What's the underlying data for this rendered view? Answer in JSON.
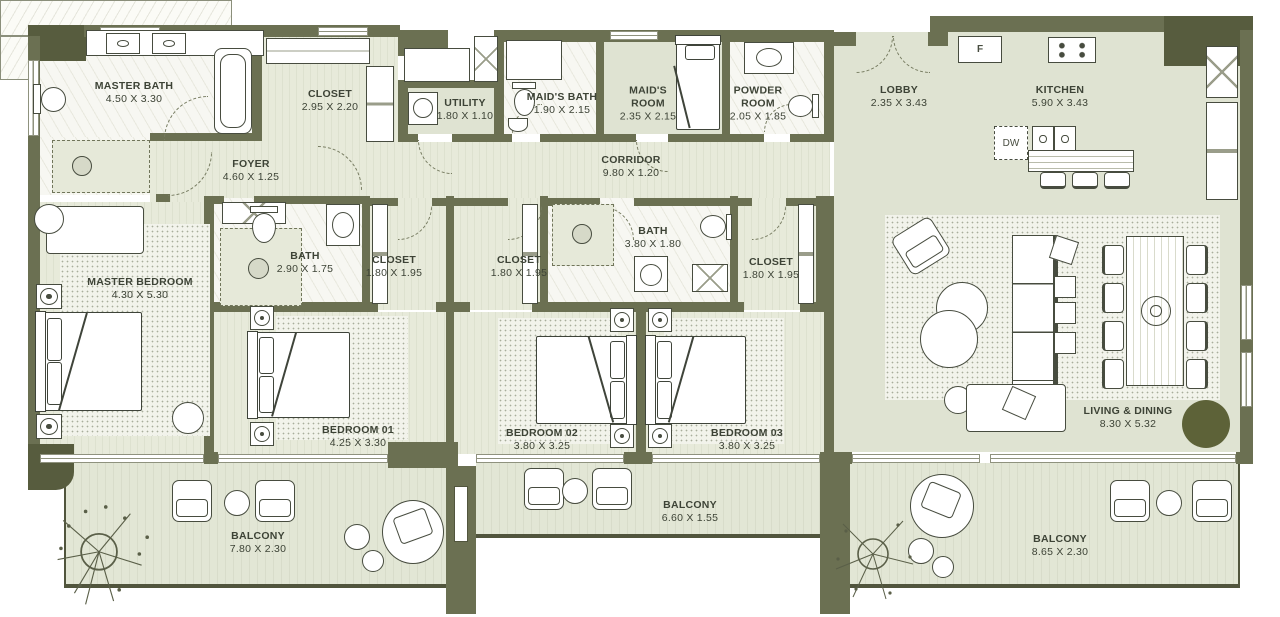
{
  "rooms": {
    "master_bath": {
      "name": "MASTER BATH",
      "dims": "4.50 X 3.30"
    },
    "closet_master": {
      "name": "CLOSET",
      "dims": "2.95 X 2.20"
    },
    "utility": {
      "name": "UTILITY",
      "dims": "1.80 X 1.10"
    },
    "maids_bath": {
      "name": "MAID'S BATH",
      "dims": "1.90 X 2.15"
    },
    "maids_room": {
      "name": "MAID'S ROOM",
      "dims": "2.35 X 2.15"
    },
    "powder_room": {
      "name": "POWDER ROOM",
      "dims": "2.05 X 1.85"
    },
    "lobby": {
      "name": "LOBBY",
      "dims": "2.35 X 3.43"
    },
    "kitchen": {
      "name": "KITCHEN",
      "dims": "5.90 X 3.43"
    },
    "foyer": {
      "name": "FOYER",
      "dims": "4.60 X 1.25"
    },
    "corridor": {
      "name": "CORRIDOR",
      "dims": "9.80 X 1.20"
    },
    "master_bedroom": {
      "name": "MASTER BEDROOM",
      "dims": "4.30 X 5.30"
    },
    "bath_master": {
      "name": "BATH",
      "dims": "2.90 X 1.75"
    },
    "closet_a": {
      "name": "CLOSET",
      "dims": "1.80 X 1.95"
    },
    "closet_b": {
      "name": "CLOSET",
      "dims": "1.80 X 1.95"
    },
    "bath_shared": {
      "name": "BATH",
      "dims": "3.80 X 1.80"
    },
    "closet_c": {
      "name": "CLOSET",
      "dims": "1.80 X 1.95"
    },
    "bedroom_01": {
      "name": "BEDROOM 01",
      "dims": "4.25 X 3.30"
    },
    "bedroom_02": {
      "name": "BEDROOM 02",
      "dims": "3.80 X 3.25"
    },
    "bedroom_03": {
      "name": "BEDROOM 03",
      "dims": "3.80 X 3.25"
    },
    "living_dining": {
      "name": "LIVING & DINING",
      "dims": "8.30 X 5.32"
    },
    "balcony_left": {
      "name": "BALCONY",
      "dims": "7.80 X 2.30"
    },
    "balcony_mid": {
      "name": "BALCONY",
      "dims": "6.60 X 1.55"
    },
    "balcony_right": {
      "name": "BALCONY",
      "dims": "8.65 X 2.30"
    }
  },
  "appliances": {
    "fridge": "F",
    "dishwasher": "DW"
  },
  "colors": {
    "wall": "#6b7052",
    "wall_dark": "#575c3e",
    "accent_circle": "#5d6238",
    "label_text": "#3d4336"
  }
}
